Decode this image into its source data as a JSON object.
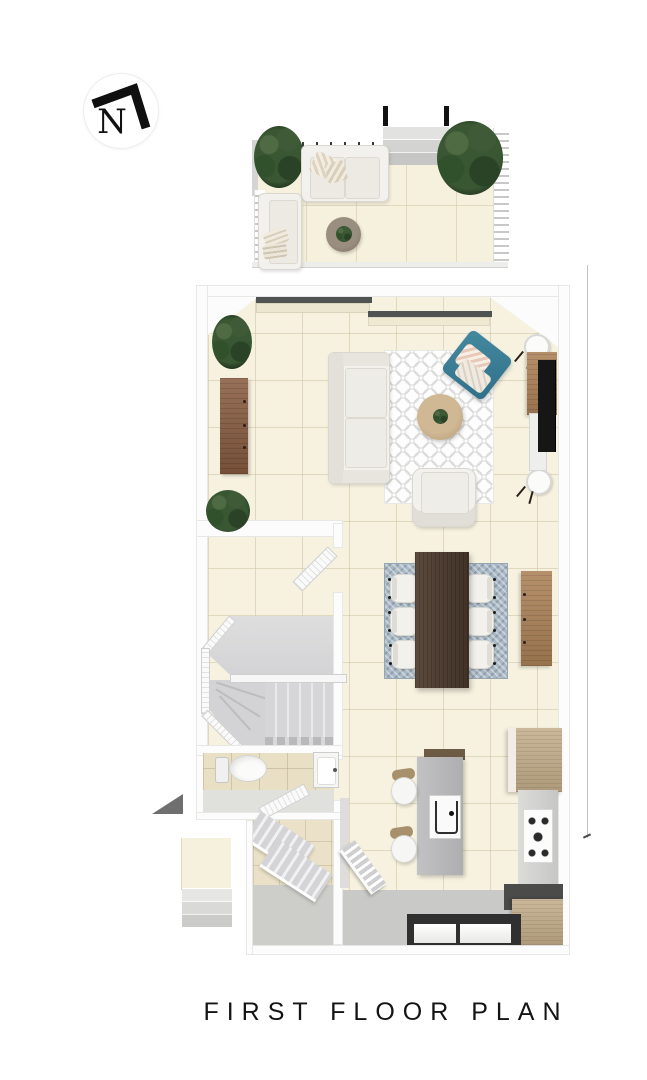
{
  "title": "FIRST FLOOR PLAN",
  "compass": {
    "label": "N",
    "icon": "north-arrow"
  },
  "palette": {
    "floor_tile": "#f7f2e0",
    "wall": "#fcfcfc",
    "stair_gray": "#d7d7d9",
    "wood_dining_table": "#4d3b2d",
    "wood_sideboard": "#8a5d42",
    "wood_console": "#ab8157",
    "wood_kitchen_cabinet": "#c2ac89",
    "rug_living": "#d9d9d7",
    "rug_dining": "#a9b8c4",
    "accent_teal_cushion": "#3a7e95",
    "plant_green": "#3a5733",
    "kitchen_counter": "#d2d2d0",
    "dark_counter": "#353535",
    "entrance_marker": "#6f6f6f"
  }
}
